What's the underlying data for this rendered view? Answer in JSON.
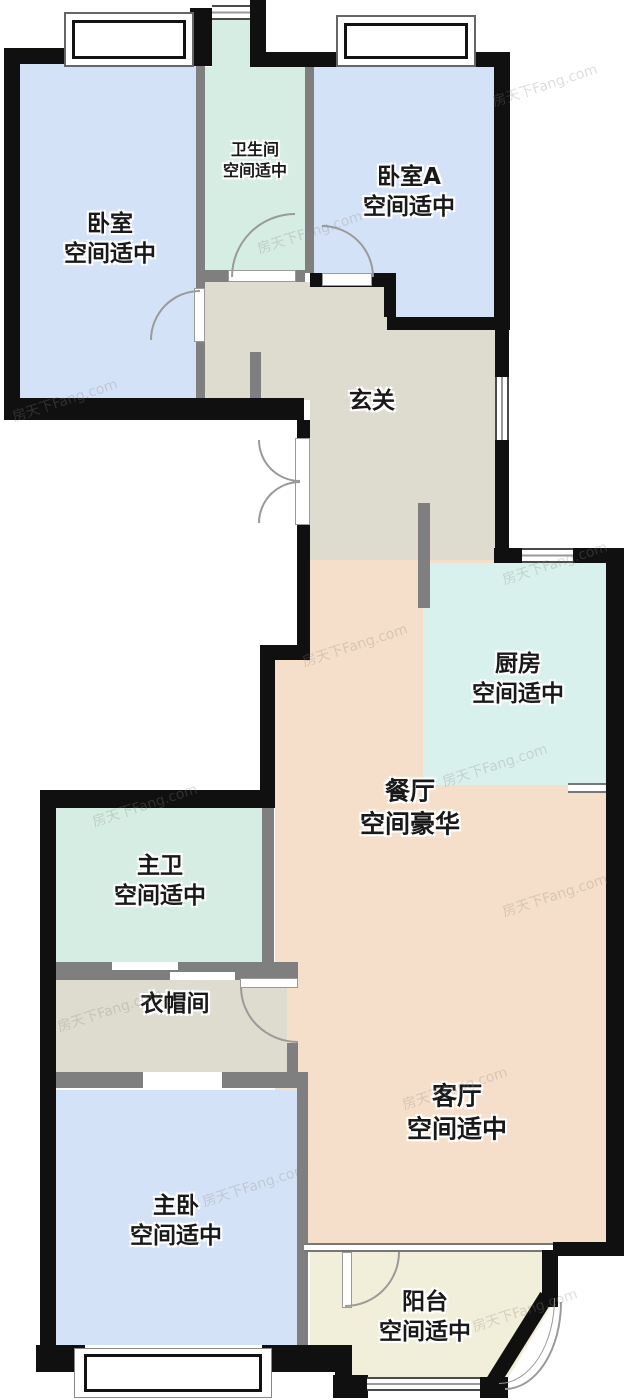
{
  "watermark": {
    "text": "房天下Fang.com"
  },
  "rooms": {
    "bedroom": {
      "name": "卧室",
      "size": "空间适中"
    },
    "bathroom": {
      "name": "卫生间",
      "size": "空间适中"
    },
    "bedroomA": {
      "name": "卧室A",
      "size": "空间适中"
    },
    "hallway": {
      "name": "玄关"
    },
    "kitchen": {
      "name": "厨房",
      "size": "空间适中"
    },
    "dining": {
      "name": "餐厅",
      "size": "空间豪华"
    },
    "masterBath": {
      "name": "主卫",
      "size": "空间适中"
    },
    "cloakroom": {
      "name": "衣帽间"
    },
    "masterBedroom": {
      "name": "主卧",
      "size": "空间适中"
    },
    "living": {
      "name": "客厅",
      "size": "空间适中"
    },
    "balcony": {
      "name": "阳台",
      "size": "空间适中"
    }
  },
  "palette": {
    "bedroom_fill": "#d4e2f7",
    "bath_fill": "#d6ede3",
    "kitchen_fill": "#d9f1ec",
    "hall_fill": "#dedccf",
    "dining_fill": "#f5dfca",
    "balcony_fill": "#f1efd9",
    "exterior_wall": "#101010",
    "interior_wall": "#7f7f7f"
  }
}
